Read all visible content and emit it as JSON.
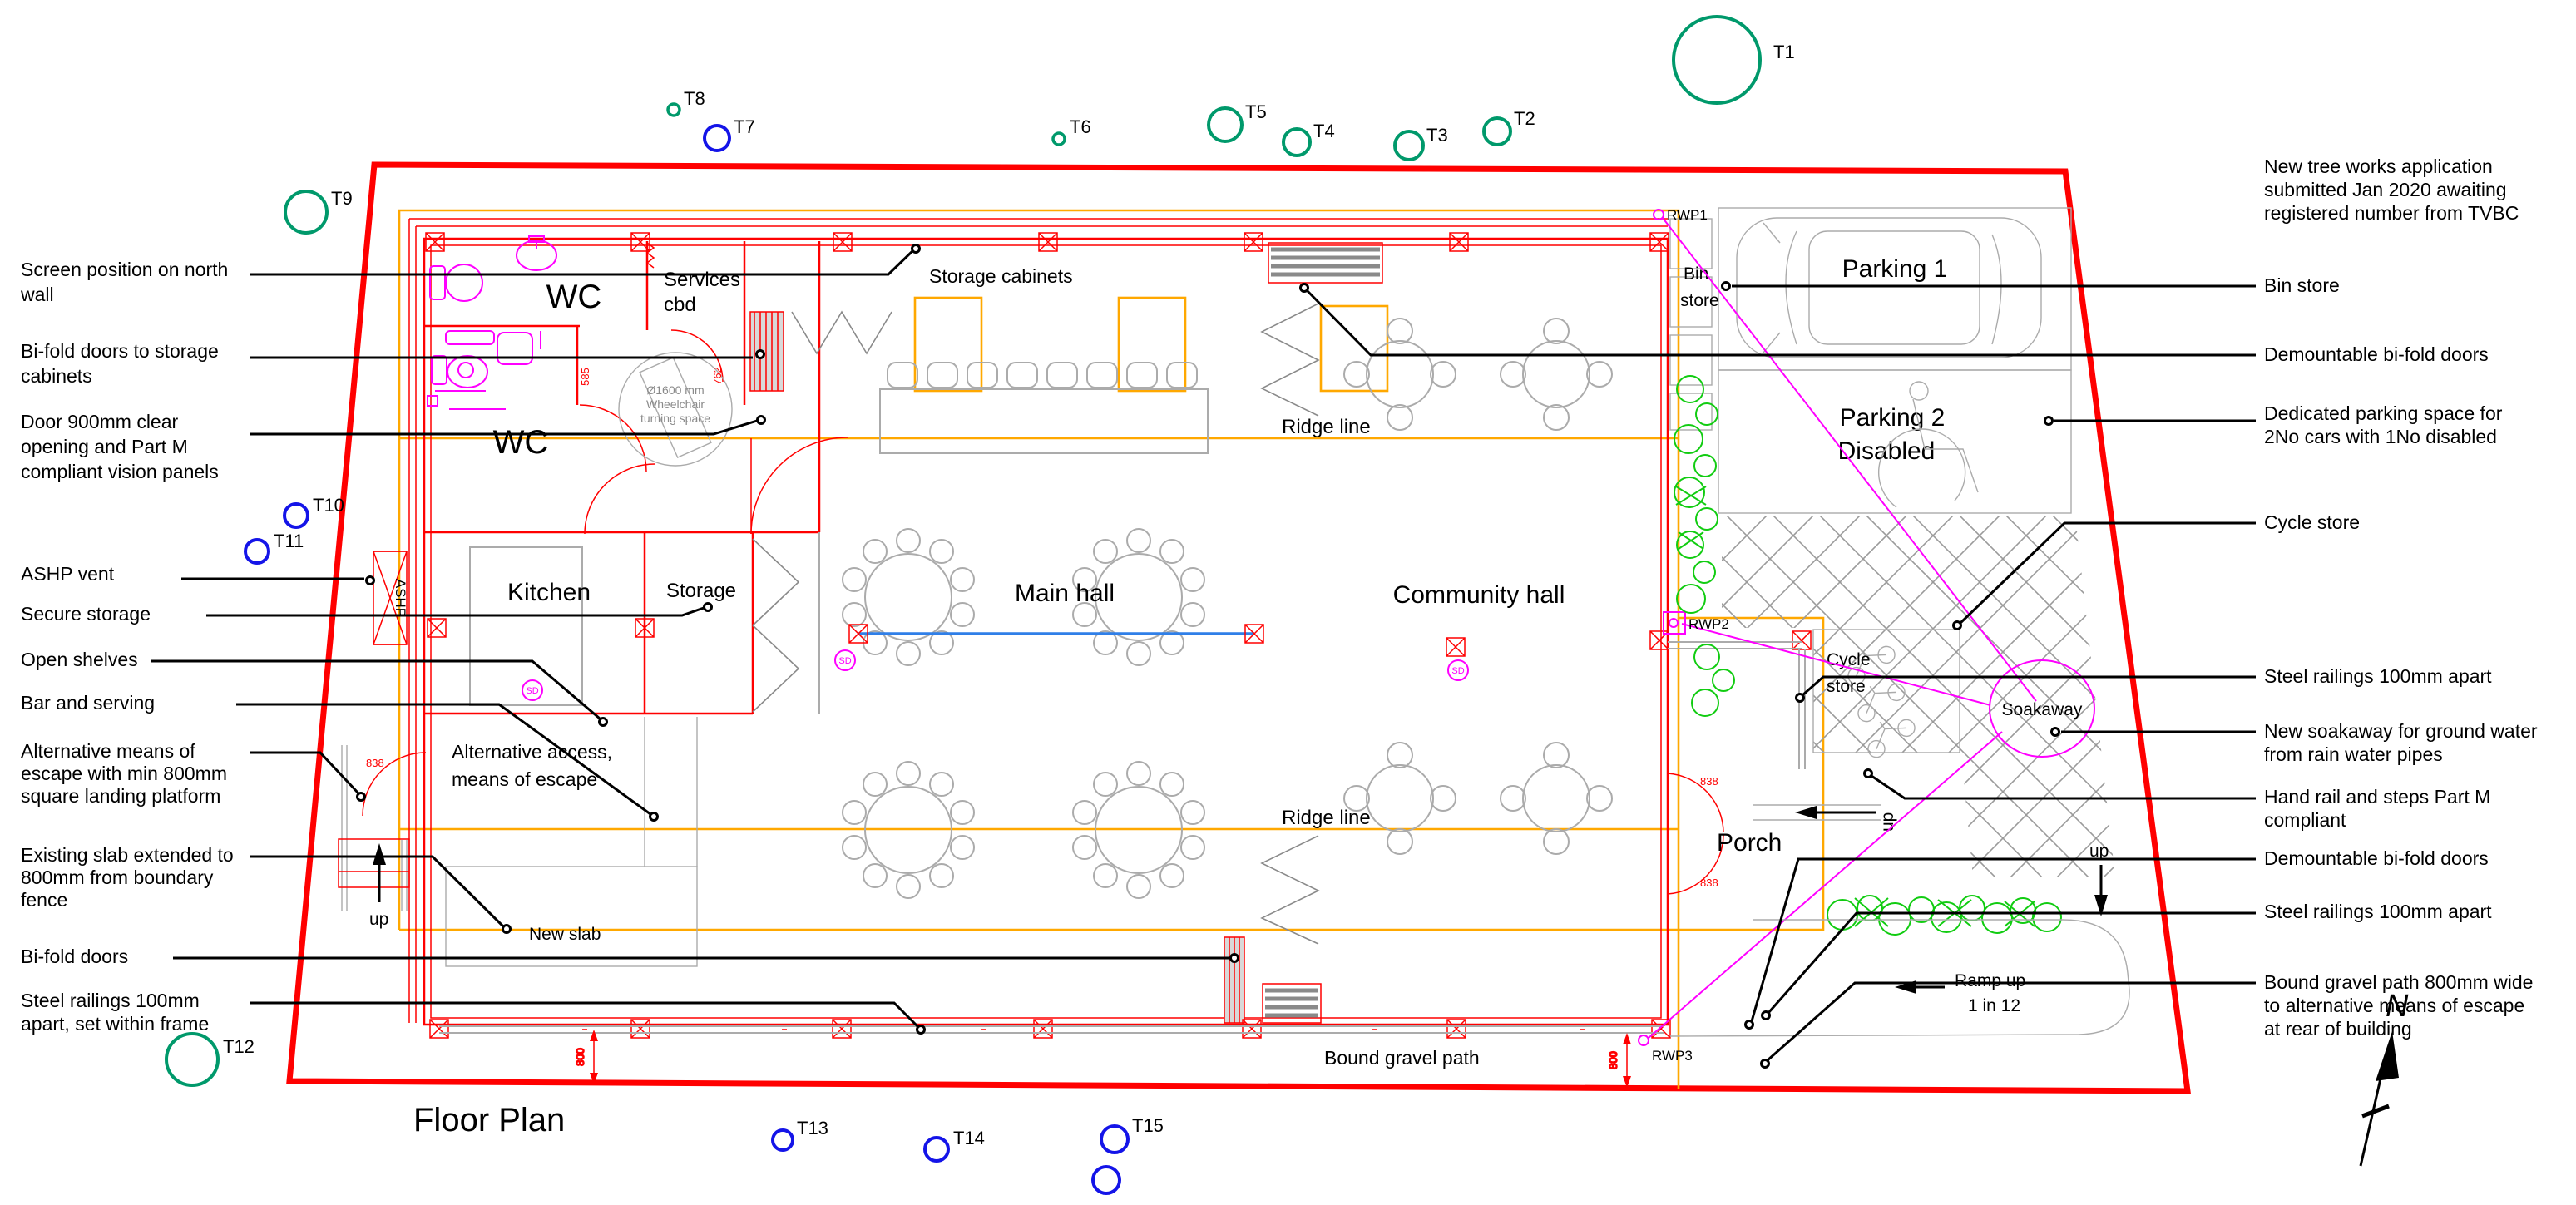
{
  "title": "Floor Plan",
  "rooms": {
    "wc": "WC",
    "services_line1": "Services",
    "services_line2": "cbd",
    "kitchen": "Kitchen",
    "storage": "Storage",
    "main_hall": "Main hall",
    "community_hall": "Community  hall",
    "porch": "Porch"
  },
  "labels": {
    "storage_cabinets": "Storage cabinets",
    "ridge_line": "Ridge line",
    "bin_line1": "Bin",
    "bin_line2": "store",
    "cycle_line1": "Cycle",
    "cycle_line2": "store",
    "soakaway": "Soakaway",
    "parking1": "Parking 1",
    "parking2_line1": "Parking 2",
    "parking2_line2": "Disabled",
    "bound_gravel_path": "Bound gravel path",
    "new_slab": "New slab",
    "alt_access_line1": "Alternative access,",
    "alt_access_line2": "means of escape",
    "ramp_line1": "Ramp up",
    "ramp_line2": "1 in 12",
    "up": "up",
    "ashp": "ASHP",
    "wheelchair_line1": "Ø1600 mm",
    "wheelchair_line2": "Wheelchair",
    "wheelchair_line3": "turning space",
    "sd": "SD",
    "rwp1": "RWP1",
    "rwp2": "RWP2",
    "rwp3": "RWP3",
    "north": "N",
    "floor_plan": "Floor Plan"
  },
  "dims": {
    "d838": "838",
    "d800": "800",
    "d762": "762",
    "d585": "585"
  },
  "left_annotations": [
    {
      "lines": [
        "Screen position on north",
        "wall"
      ]
    },
    {
      "lines": [
        "Bi-fold doors to storage",
        "cabinets"
      ]
    },
    {
      "lines": [
        "Door 900mm clear",
        "opening and Part M",
        "compliant vision panels"
      ]
    },
    {
      "lines": [
        "ASHP vent"
      ]
    },
    {
      "lines": [
        "Secure storage"
      ]
    },
    {
      "lines": [
        "Open shelves"
      ]
    },
    {
      "lines": [
        "Bar and serving"
      ]
    },
    {
      "lines": [
        "Alternative means of",
        "escape with min 800mm",
        "square landing platform"
      ]
    },
    {
      "lines": [
        "Existing slab extended to",
        "800mm from boundary",
        "fence"
      ]
    },
    {
      "lines": [
        "Bi-fold doors"
      ]
    },
    {
      "lines": [
        "Steel railings 100mm",
        "apart, set within frame"
      ]
    }
  ],
  "right_annotations": [
    {
      "lines": [
        "New tree works application",
        "submitted Jan 2020 awaiting",
        "registered number from TVBC"
      ]
    },
    {
      "lines": [
        "Bin store"
      ]
    },
    {
      "lines": [
        "Demountable bi-fold doors"
      ]
    },
    {
      "lines": [
        "Dedicated parking space for",
        "2No cars with 1No disabled"
      ]
    },
    {
      "lines": [
        "Cycle store"
      ]
    },
    {
      "lines": [
        "Steel railings 100mm apart"
      ]
    },
    {
      "lines": [
        "New soakaway for ground water",
        "from rain water pipes"
      ]
    },
    {
      "lines": [
        "Hand rail and steps Part M",
        "compliant"
      ]
    },
    {
      "lines": [
        "Demountable bi-fold doors"
      ]
    },
    {
      "lines": [
        "Steel railings 100mm apart"
      ]
    },
    {
      "lines": [
        "Bound gravel path 800mm wide",
        "to alternative means of escape",
        "at rear of building"
      ]
    }
  ],
  "trees": [
    {
      "id": "T1"
    },
    {
      "id": "T2"
    },
    {
      "id": "T3"
    },
    {
      "id": "T4"
    },
    {
      "id": "T5"
    },
    {
      "id": "T6"
    },
    {
      "id": "T7"
    },
    {
      "id": "T8"
    },
    {
      "id": "T9"
    },
    {
      "id": "T10"
    },
    {
      "id": "T11"
    },
    {
      "id": "T12"
    },
    {
      "id": "T13"
    },
    {
      "id": "T14"
    },
    {
      "id": "T15"
    }
  ],
  "colors": {
    "boundary": "#ff0000",
    "roof": "#ffa800",
    "sanitary": "#ff00ff",
    "tree_green": "#00996b",
    "tree_blue": "#1414e8",
    "bush_green": "#11cc11",
    "screen_blue": "#2f7fe8",
    "furniture_gray": "#ababab"
  }
}
